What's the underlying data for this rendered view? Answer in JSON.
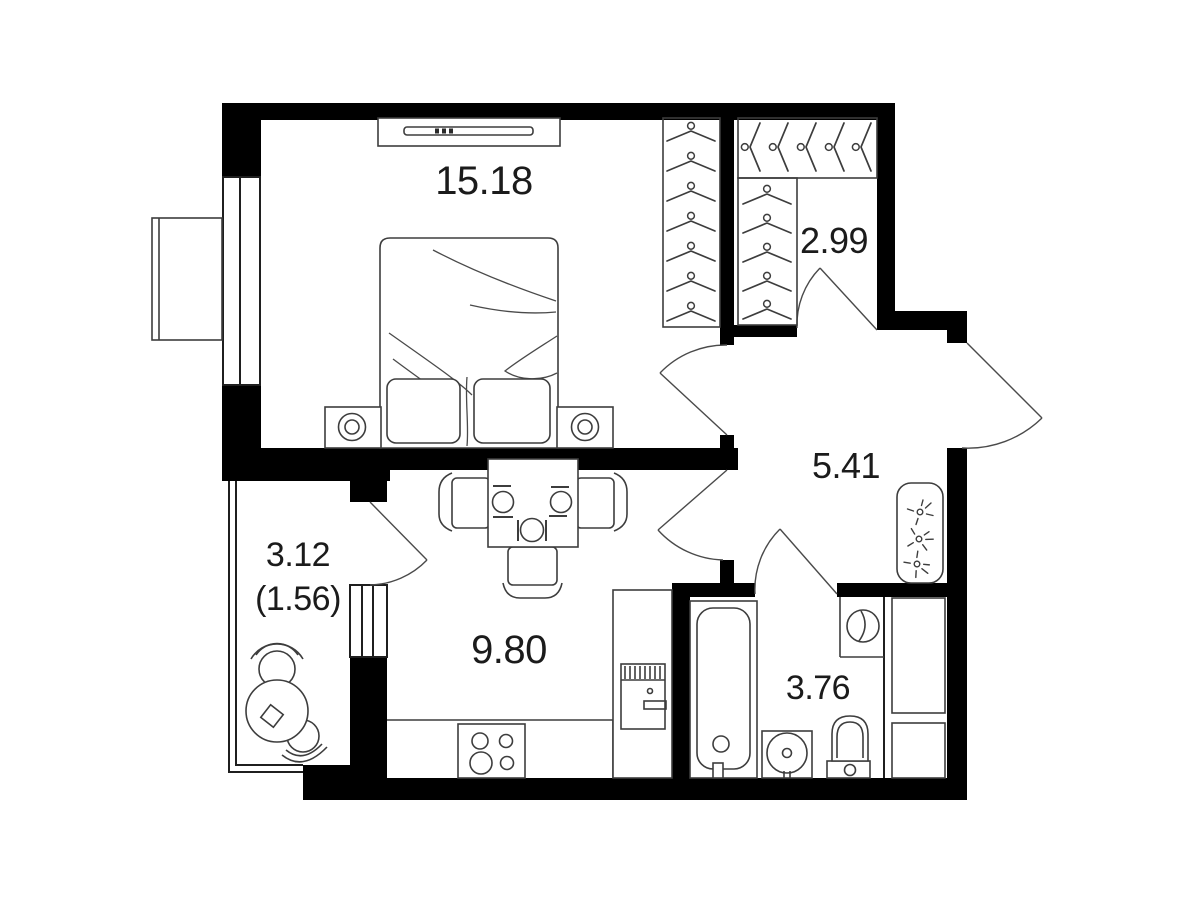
{
  "title": "apartment-floor-plan",
  "rooms": {
    "bedroom": {
      "area": "15.18"
    },
    "wardrobe": {
      "area": "2.99"
    },
    "hallway": {
      "area": "5.41"
    },
    "kitchen": {
      "area": "9.80"
    },
    "bathroom": {
      "area": "3.76"
    },
    "balcony": {
      "area_total": "3.12",
      "area_reduced": "(1.56)"
    }
  },
  "colors": {
    "wall": "#000000",
    "furniture_line": "#3d3d3d",
    "door_arc": "#4a4a4a",
    "label_text": "#1b1b1b",
    "background": "#ffffff"
  },
  "icons": {
    "hanger-icon": "chevron-with-hook-circle",
    "hook-icon": "circle-with-radiating-dashes",
    "bed": "rect-with-two-pillows-and-blanket-folds",
    "tv-console": "long-rect-with-thin-screen-bar",
    "nightstand": "square-with-double-circle-lamp",
    "dining-table": "rect-with-three-plates-and-cutlery",
    "stove": "square-with-four-burner-circles",
    "fridge": "tall-rect-with-vent-and-handle",
    "bathtub": "rect-with-rounded-inner-tub-and-drain",
    "sink": "square-with-round-basin",
    "toilet": "bowl-with-tank",
    "washing-machine": "square-niche-with-drum-circle",
    "balcony-table": "circle-with-diamond",
    "balcony-chair": "circle-seat-with-back-arc"
  }
}
